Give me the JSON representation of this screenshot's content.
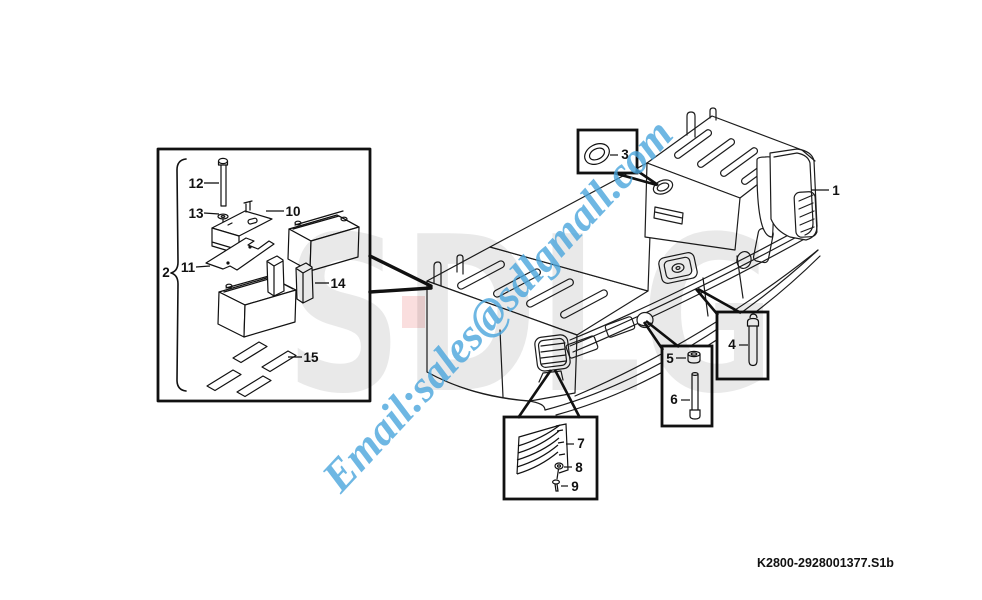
{
  "watermarks": {
    "email": "Email:sales@sdlgmall.com",
    "email_color": "#4ba6dd",
    "logo_text": "SDLG",
    "logo_color": "rgba(0,0,0,0.085)",
    "logo_accent_color": "rgba(231,90,90,0.20)"
  },
  "footer": {
    "doc_code": "K2800-2928001377.S1b"
  },
  "part_labels": {
    "p1": "1",
    "p2": "2",
    "p3": "3",
    "p4": "4",
    "p5": "5",
    "p6": "6",
    "p7": "7",
    "p8": "8",
    "p9": "9",
    "p10": "10",
    "p11": "11",
    "p12": "12",
    "p13": "13",
    "p14": "14",
    "p15": "15"
  }
}
